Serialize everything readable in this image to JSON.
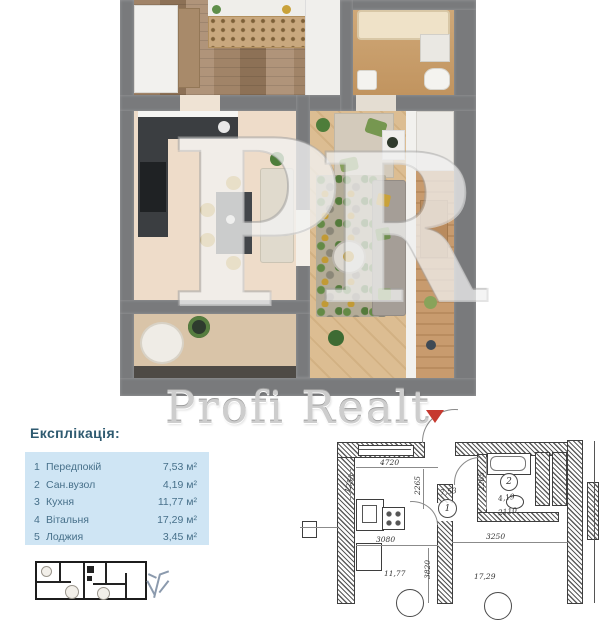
{
  "watermark": {
    "text": "Profi Realt",
    "ghost_letter_1": "P",
    "ghost_letter_2": "R"
  },
  "explication": {
    "title": "Експлікація:",
    "rows": [
      {
        "num": "1",
        "name": "Передпокій",
        "area": "7,53 м²"
      },
      {
        "num": "2",
        "name": "Сан.вузол",
        "area": "4,19 м²"
      },
      {
        "num": "3",
        "name": "Кухня",
        "area": "11,77 м²"
      },
      {
        "num": "4",
        "name": "Вітальня",
        "area": "17,29 м²"
      },
      {
        "num": "5",
        "name": "Лоджия",
        "area": "3,45 м²"
      }
    ]
  },
  "tech_plan": {
    "dim_top": "4720",
    "dim_hall_height": "2265",
    "dim_bath_height": "2265",
    "dim_left": "1255",
    "dim_bath_width": "2110",
    "dim_kitchen_width": "3080",
    "dim_living_width": "3250",
    "dim_kitchen_height": "3820",
    "room1_num": "1",
    "room1_area": "7,53",
    "room2_num": "2",
    "room2_area": "4,19",
    "kitchen_area": "11,77",
    "living_area": "17,29"
  },
  "colors": {
    "wall_gray": "#797a7c",
    "explication_panel": "#cfe5f4",
    "explication_text": "#47708a",
    "entry_marker_red": "#c6392f",
    "watermark_gray": "#cdcdcd"
  }
}
